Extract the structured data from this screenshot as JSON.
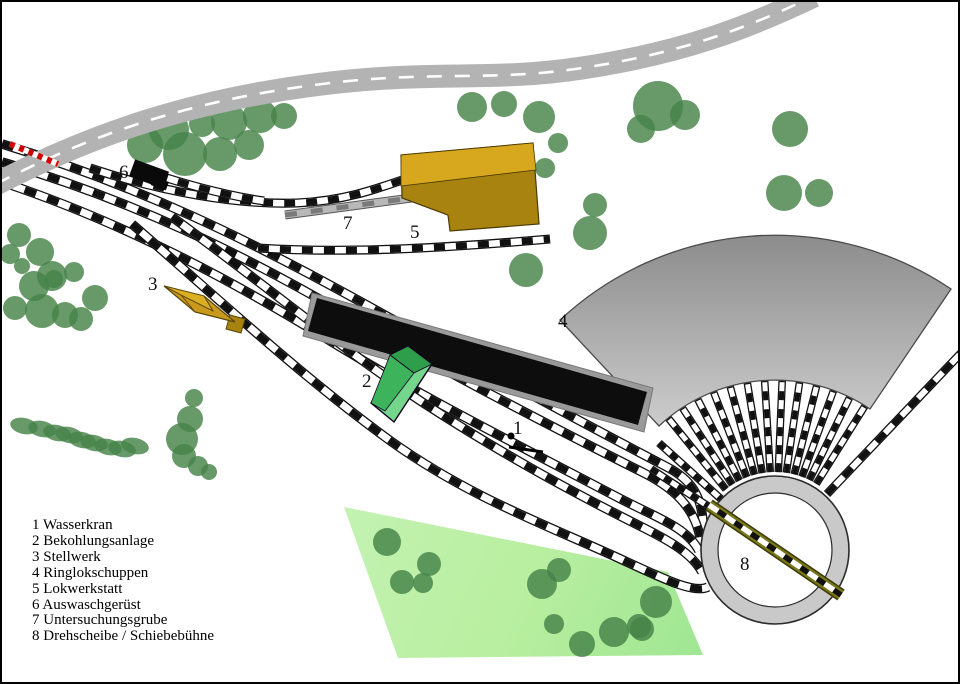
{
  "title": "Bahnbetriebswerk Gleisplan (railway depot track plan)",
  "map_labels": [
    "1",
    "2",
    "3",
    "4",
    "5",
    "6",
    "7",
    "8"
  ],
  "legend": {
    "items": [
      "1 Wasserkran",
      "2 Bekohlungsanlage",
      "3 Stellwerk",
      "4 Ringlokschuppen",
      "5 Lokwerkstatt",
      "6 Auswaschgerüst",
      "7 Untersuchungsgrube",
      "8 Drehscheibe / Schiebebühne"
    ]
  },
  "colors": {
    "background": "#ffffff",
    "track_black": "#111111",
    "track_white": "#ffffff",
    "road_gray": "#b3b3b3",
    "road_dash": "#ffffff",
    "crossing_red": "#d40000",
    "tree_green": "rgba(70,130,72,0.82)",
    "grass_light": "#c3f2b2",
    "grass_dark": "#9fe693",
    "building_gold_light": "#d7a81d",
    "building_gold_dark": "#a8830f",
    "building_gold_mid": "#c9991b",
    "building_gold_pale": "#dcae22",
    "box_green_front": "#3db45b",
    "box_green_light": "#74d68b",
    "box_green_dark": "#2f9e4a",
    "platform_black": "#0d0d0d",
    "platform_gray": "#9a9a9a",
    "roundhouse_dark": "#8b8b8b",
    "roundhouse_light": "#cfcfcf",
    "turntable_ring": "#c9c9c9",
    "pit_light": "#b8b8b8",
    "pit_dark": "#555555",
    "bridge_olive": "#787818",
    "label_color": "#111111"
  }
}
